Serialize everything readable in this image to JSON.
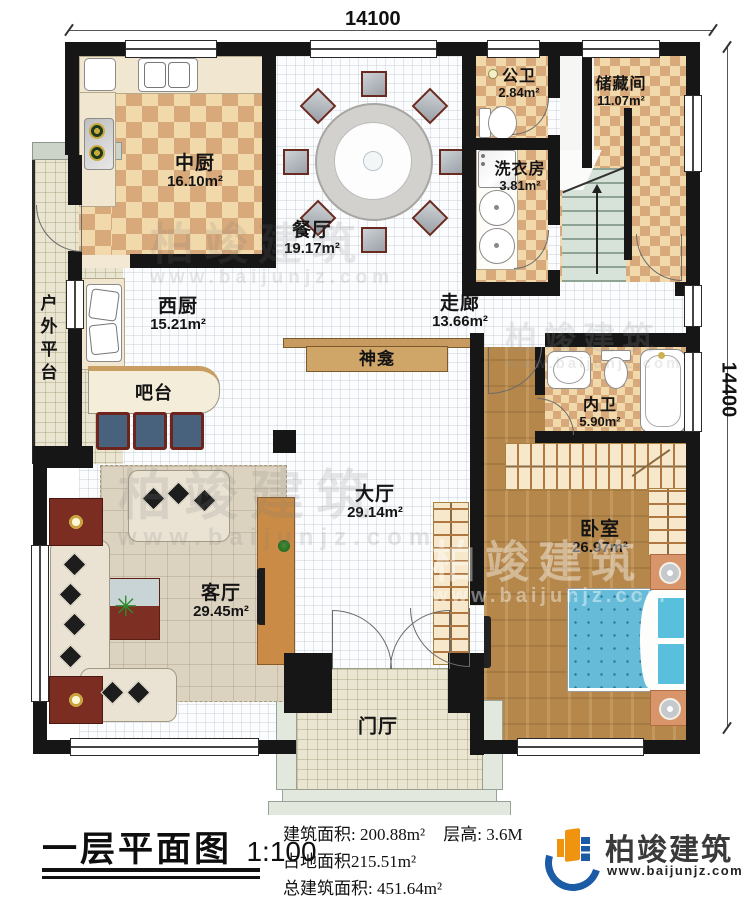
{
  "dimensions": {
    "width_label": "14100",
    "height_label": "14400"
  },
  "rooms": {
    "zhongchu": {
      "name": "中厨",
      "area": "16.10m²"
    },
    "canting": {
      "name": "餐厅",
      "area": "19.17m²"
    },
    "gongwei": {
      "name": "公卫",
      "area": "2.84m²"
    },
    "chucangjian": {
      "name": "储藏间",
      "area": "11.07m²"
    },
    "xiyifang": {
      "name": "洗衣房",
      "area": "3.81m²"
    },
    "zoulang": {
      "name": "走廊",
      "area": "13.66m²"
    },
    "xichu": {
      "name": "西厨",
      "area": "15.21m²"
    },
    "neiwei": {
      "name": "内卫",
      "area": "5.90m²"
    },
    "dating": {
      "name": "大厅",
      "area": "29.14m²"
    },
    "woshi": {
      "name": "卧室",
      "area": "26.97m²"
    },
    "keting": {
      "name": "客厅",
      "area": "29.45m²"
    },
    "menting": {
      "name": "门厅"
    },
    "huwaipingtai": {
      "name": "户外平台"
    },
    "batai": {
      "name": "吧台"
    },
    "shenkan": {
      "name": "神龛"
    }
  },
  "title": {
    "main": "一层平面图",
    "scale": "1:100"
  },
  "stats": {
    "line1a": "建筑面积: 200.88m²",
    "line1b": "层高: 3.6M",
    "line2": "占地面积215.51m²",
    "line3": "总建筑面积: 451.64m²"
  },
  "brand": {
    "name": "柏竣建筑",
    "url": "www.baijunjz.com"
  },
  "watermark": {
    "name": "柏竣建筑",
    "url": "www.baijunjz.com"
  }
}
